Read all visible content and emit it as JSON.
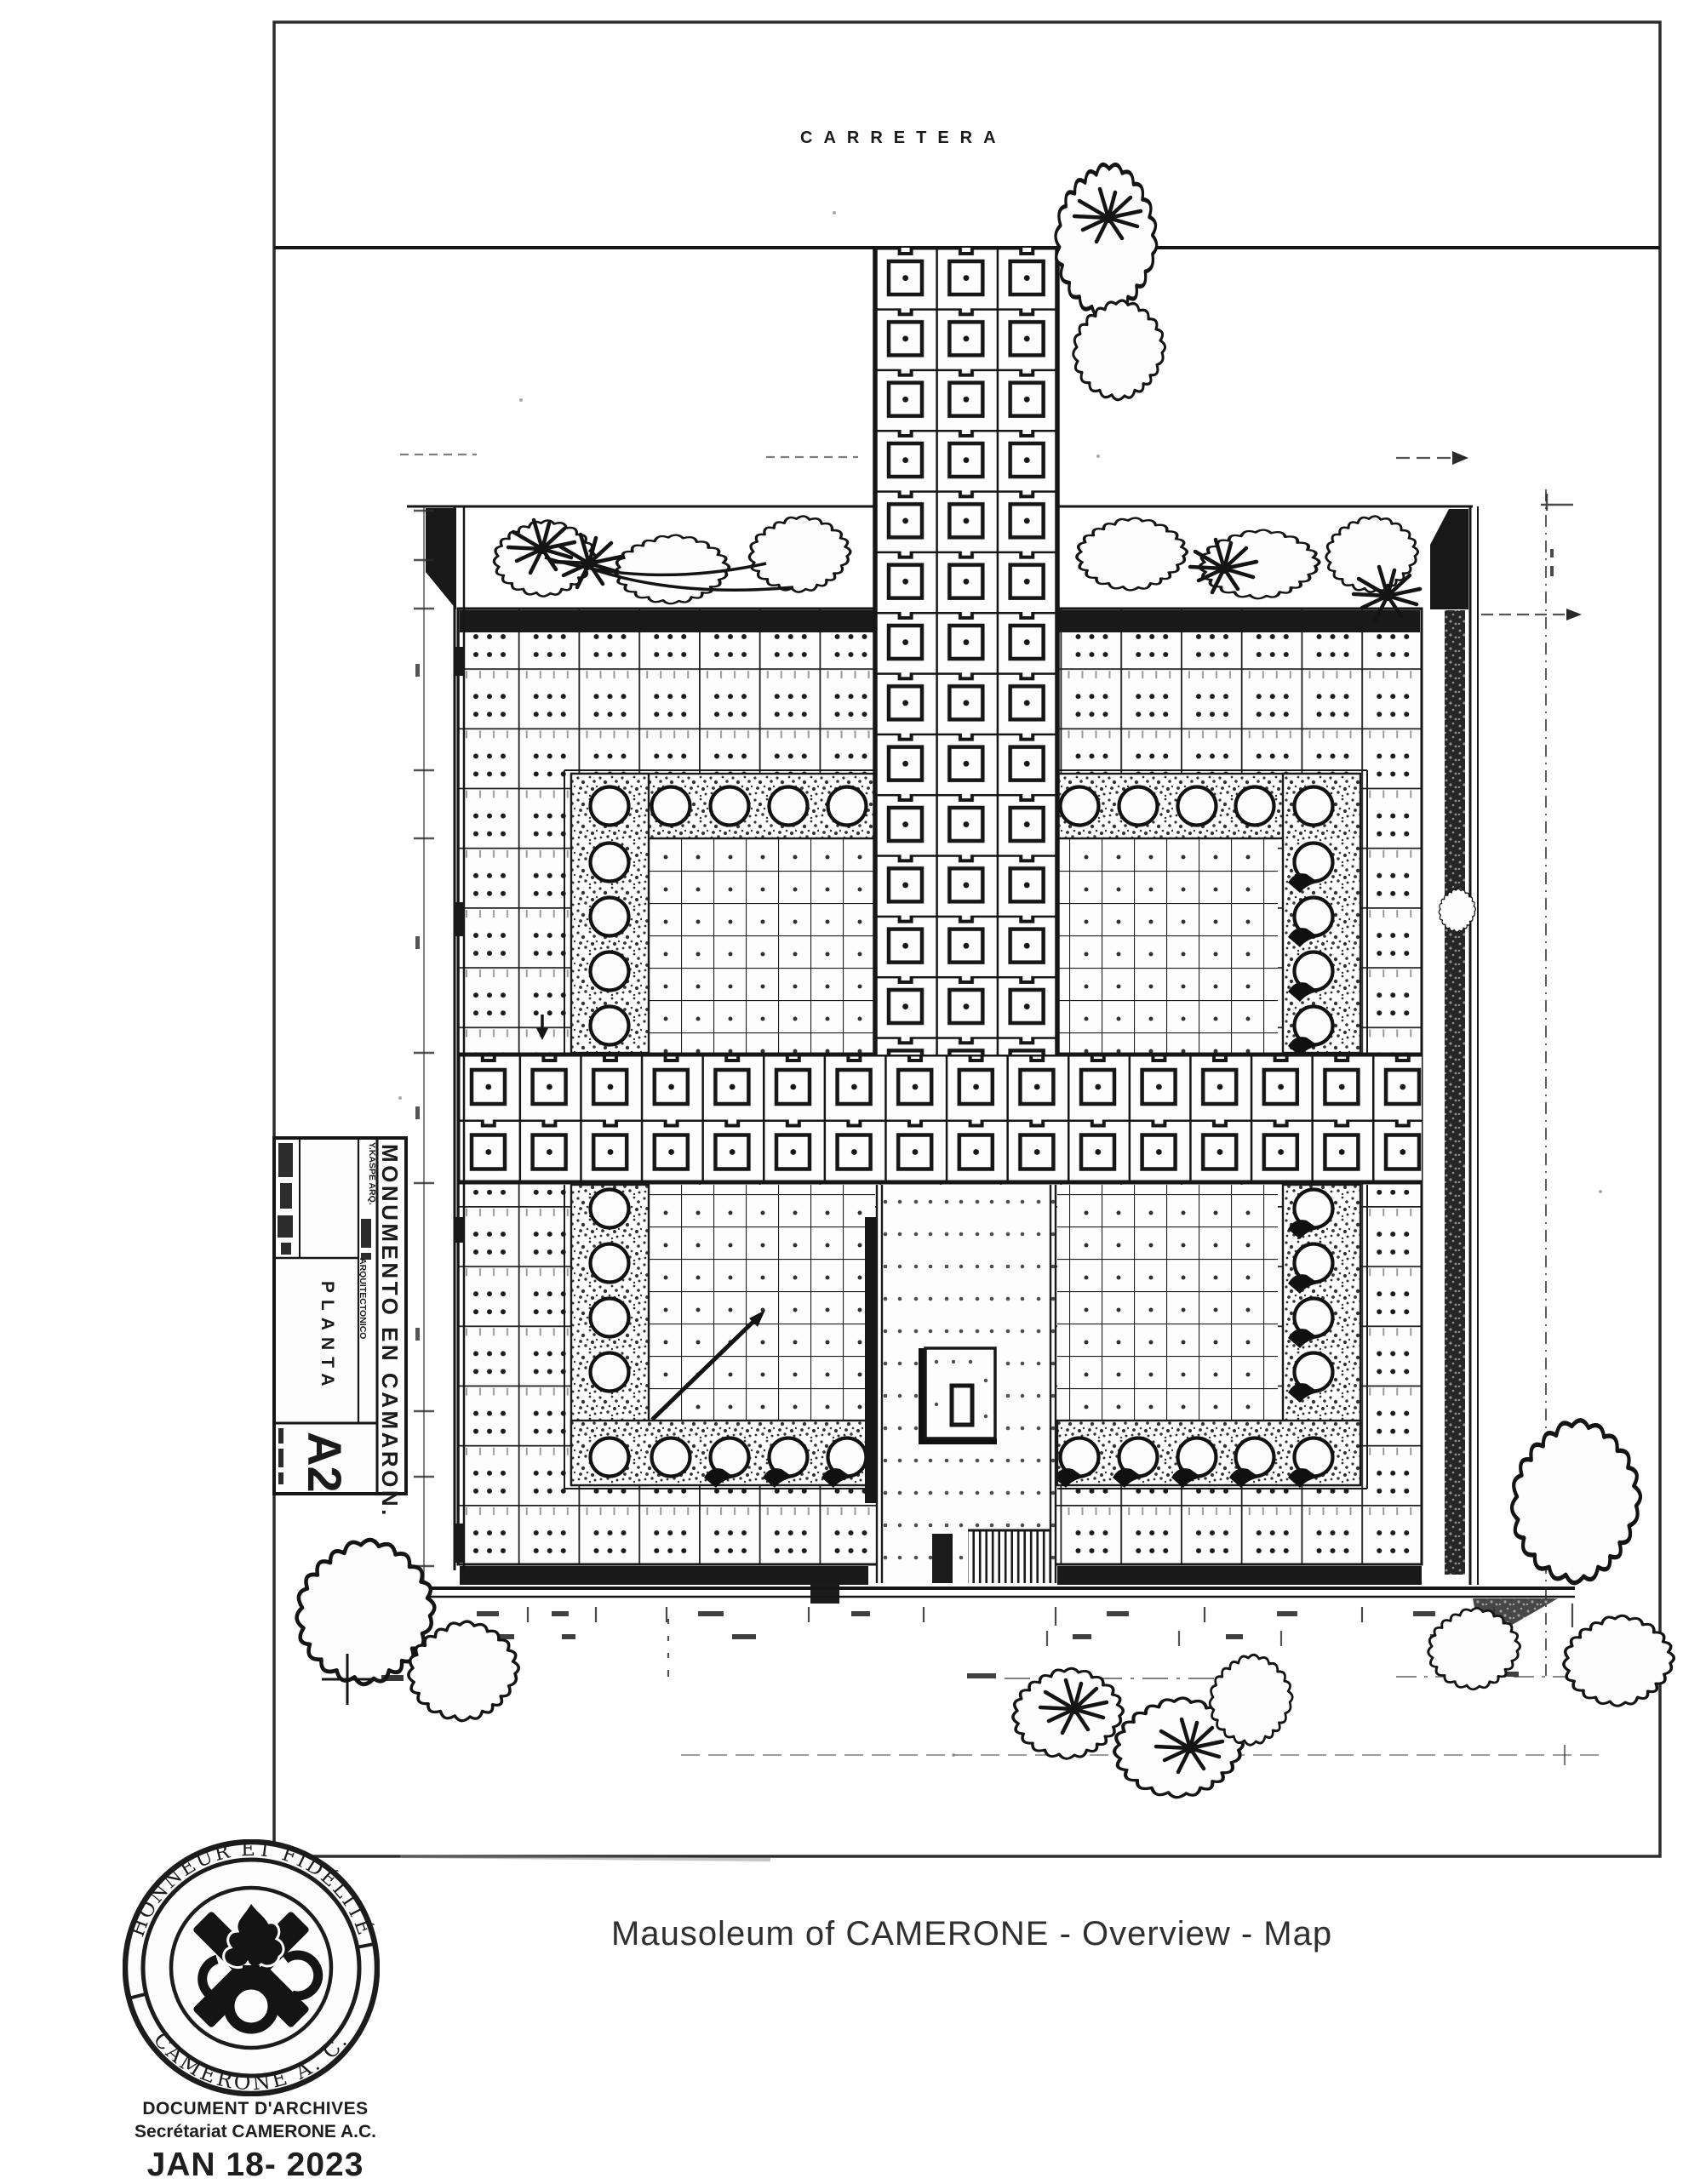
{
  "plan": {
    "road_label": "CARRETERA",
    "title_block": {
      "project": "MONUMENTO EN CAMARON.",
      "credit_line1": "Y.KASPE ARQ.",
      "credit_line2": "ARQUITECTONICO",
      "sheet_name": "PLANTA",
      "sheet_code": "A2"
    }
  },
  "seal": {
    "motto_top": "HONNEUR ET FIDÉLITÉ",
    "motto_bottom": "CAMERONE A. C."
  },
  "caption": "Mausoleum of CAMERONE - Overview - Map",
  "footer": {
    "line1": "DOCUMENT D'ARCHIVES",
    "line2": "Secrétariat CAMERONE A.C.",
    "date": "JAN 18- 2023"
  }
}
